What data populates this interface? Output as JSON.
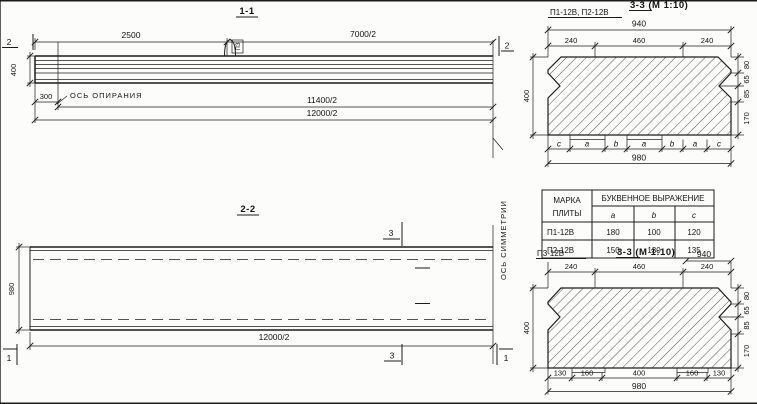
{
  "view_1_1": {
    "title": "1-1",
    "cut_marker_left": "2",
    "cut_marker_right": "2",
    "dim_2500": "2500",
    "dim_7000": "7000/2",
    "dim_height": "400",
    "dim_300": "300",
    "dim_11400": "11400/2",
    "dim_12000": "12000/2",
    "support_axis_label": "ОСЬ ОПИРАНИЯ",
    "hook_flag": "ПЗ"
  },
  "view_2_2": {
    "title": "2-2",
    "dim_width": "980",
    "dim_length": "12000/2",
    "cut_marker_top": "3",
    "cut_marker_bottom": "3",
    "end_marker_left": "1",
    "end_marker_right": "1",
    "symmetry_axis_label": "ОСЬ СИММЕТРИИ"
  },
  "detail_p12": {
    "marks_label": "П1-12В, П2-12В",
    "section_title": "3-3 (М 1:10)",
    "dim_top": "940",
    "dims_940": [
      "240",
      "460",
      "240"
    ],
    "dim_height": "400",
    "dims_right": [
      "80",
      "65",
      "85",
      "170"
    ],
    "seg_letters": [
      "c",
      "a",
      "b",
      "a",
      "b",
      "a",
      "c"
    ],
    "dim_bottom": "980"
  },
  "dim_table": {
    "header_col1_line1": "МАРКА",
    "header_col1_line2": "ПЛИТЫ",
    "header_expr": "БУКВЕННОЕ  ВЫРАЖЕНИЕ",
    "letters": [
      "a",
      "b",
      "c"
    ],
    "rows": [
      [
        "П1-12В",
        "180",
        "100",
        "120"
      ],
      [
        "П2-12В",
        "150",
        "130",
        "135"
      ]
    ]
  },
  "detail_p3": {
    "mark_label": "П3-12В",
    "section_title": "3-3 (М 1:10)",
    "dim_top": "940",
    "dims_940": [
      "240",
      "460",
      "240"
    ],
    "dim_height": "400",
    "dims_right": [
      "80",
      "65",
      "85",
      "170"
    ],
    "dims_bottom": [
      "130",
      "160",
      "400",
      "160",
      "130"
    ],
    "dim_overall": "980"
  }
}
